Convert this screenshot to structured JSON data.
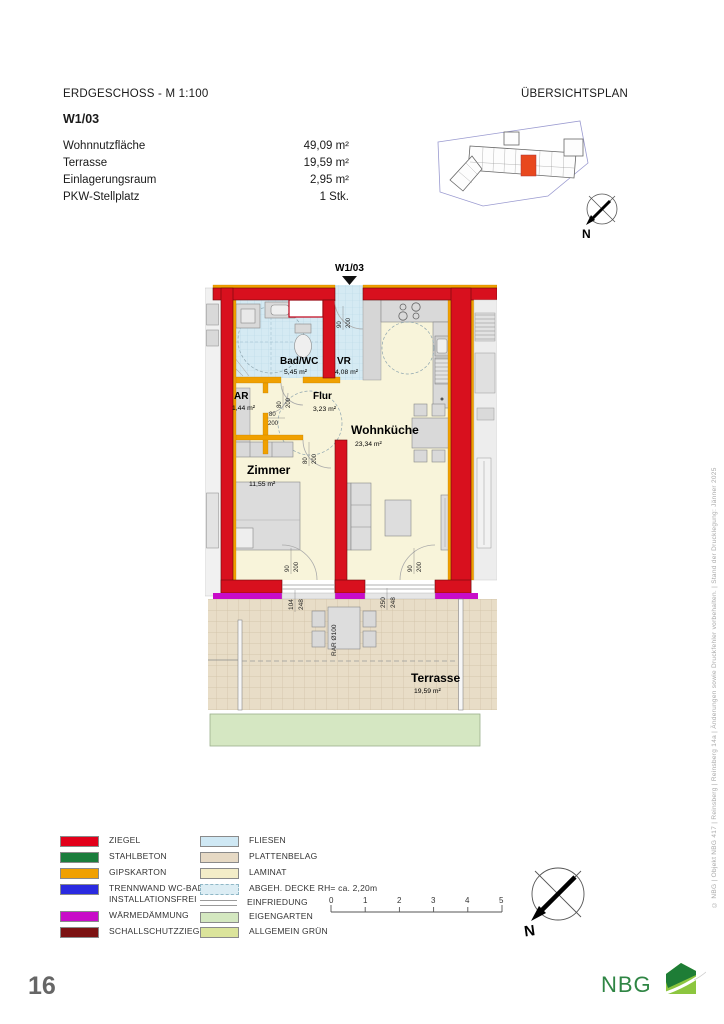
{
  "header": {
    "plan_title": "ERDGESCHOSS -  M 1:100",
    "overview_title": "ÜBERSICHTSPLAN",
    "unit": "W1/03",
    "stats": [
      {
        "label": "Wohnnutzfläche",
        "value": "49,09 m²"
      },
      {
        "label": "Terrasse",
        "value": "19,59 m²"
      },
      {
        "label": "Einlagerungsraum",
        "value": "2,95 m²"
      },
      {
        "label": "PKW-Stellplatz",
        "value": "1 Stk."
      }
    ]
  },
  "floorplan": {
    "unit_label": "W1/03",
    "rooms": {
      "badwc": {
        "name": "Bad/WC",
        "area": "5,45 m²"
      },
      "vr": {
        "name": "VR",
        "area": "4,08 m²"
      },
      "ar": {
        "name": "AR",
        "area": "1,44 m²"
      },
      "flur": {
        "name": "Flur",
        "area": "3,23 m²"
      },
      "wohnkueche": {
        "name": "Wohnküche",
        "area": "23,34 m²"
      },
      "zimmer": {
        "name": "Zimmer",
        "area": "11,55 m²"
      },
      "terrasse": {
        "name": "Terrasse",
        "area": "19,59 m²"
      }
    },
    "doors": {
      "entrance": {
        "w": "90",
        "h": "200"
      },
      "bad": {
        "w": "80",
        "h": "200"
      },
      "ar": {
        "w": "80",
        "h": "200"
      },
      "zimmer": {
        "w": "80",
        "h": "200"
      },
      "zimmer_terrace": {
        "w": "90",
        "h": "200"
      },
      "wohnkueche_terrace": {
        "w": "90",
        "h": "200"
      }
    },
    "dims": {
      "left": {
        "w": "104",
        "h": "248"
      },
      "right": {
        "w": "250",
        "h": "248"
      },
      "drain": "RAR Ø100"
    }
  },
  "legend": {
    "left": [
      {
        "label": "ZIEGEL",
        "color": "#e2001a"
      },
      {
        "label": "STAHLBETON",
        "color": "#1b7d3c"
      },
      {
        "label": "GIPSKARTON",
        "color": "#f0a000"
      },
      {
        "label": "TRENNWAND WC-BAD INSTALLATIONSFREI",
        "color": "#2a2ae0"
      },
      {
        "label": "WÄRMEDÄMMUNG",
        "color": "#c80cc8"
      },
      {
        "label": "SCHALLSCHUTZZIEGEL",
        "color": "#7c1212"
      }
    ],
    "right": [
      {
        "label": "FLIESEN",
        "color": "#cfe8f4"
      },
      {
        "label": "PLATTENBELAG",
        "color": "#e6d9c4"
      },
      {
        "label": "LAMINAT",
        "color": "#f3edc8"
      },
      {
        "label": "ABGEH. DECKE RH= ca. 2,20m",
        "color": "#dcedf4"
      },
      {
        "label": "EINFRIEDUNG",
        "color": "#9a9a9a"
      },
      {
        "label": "EIGENGARTEN",
        "color": "#d4e8c0"
      },
      {
        "label": "ALLGEMEIN GRÜN",
        "color": "#dbe49b"
      }
    ]
  },
  "scalebar": {
    "ticks": [
      "0",
      "1",
      "2",
      "3",
      "4",
      "5"
    ]
  },
  "compass": {
    "north_label": "N"
  },
  "footer": {
    "page_number": "16",
    "copyright": "© NBG | Objekt NBG 417 | Reinsberg | Reinsberg 14a | Änderungen sowie Druckfehler vorbehalten. | Stand der Drucklegung: Jänner 2025",
    "logo_text": "NBG"
  }
}
